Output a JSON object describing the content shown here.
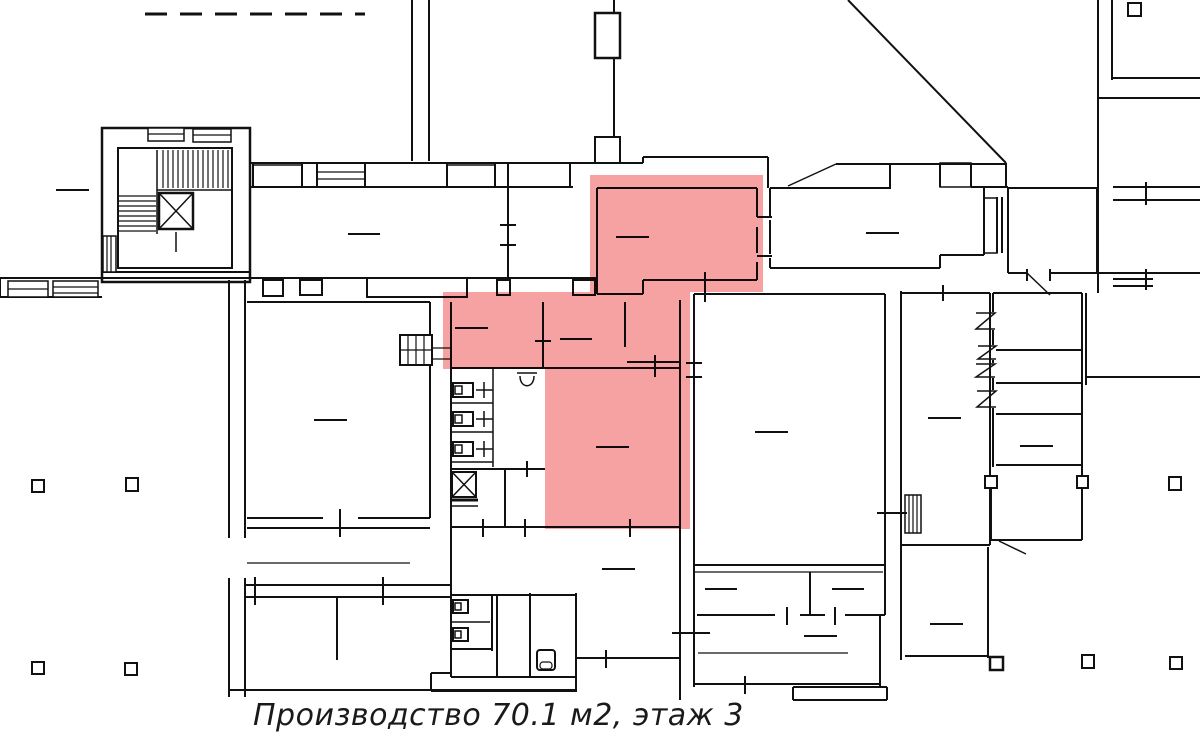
{
  "caption": {
    "text": "Производство 70.1 м2, этаж 3"
  },
  "highlighted_space": {
    "type": "Производство",
    "area_label": "70.1 м2",
    "area_m2": "70.1",
    "floor_label": "этаж 3",
    "floor": "3"
  },
  "colors": {
    "wall": "#111111",
    "highlight": "#f7a2a2",
    "bg": "#ffffff",
    "caption": "#1a1a1a"
  }
}
